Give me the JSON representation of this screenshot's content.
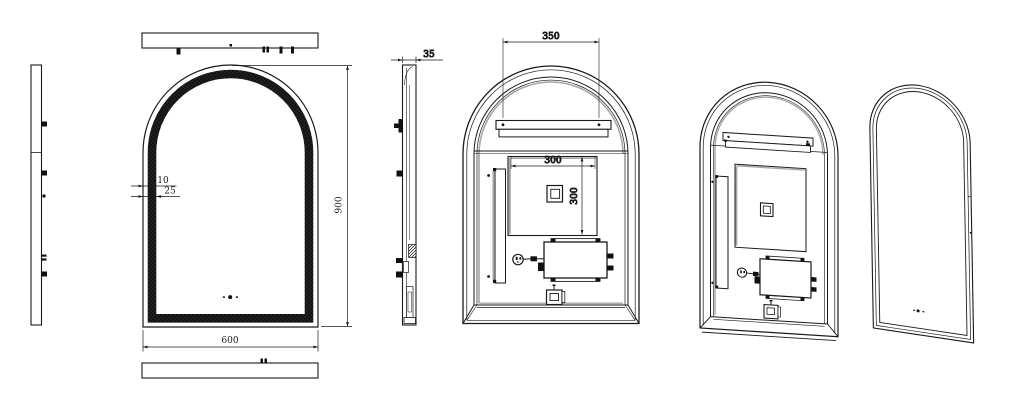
{
  "dimensions": {
    "front_frame_offset": "10",
    "front_led_band": "25",
    "front_width": "600",
    "front_height": "900",
    "side_depth": "35",
    "hanger_width": "350",
    "backplate_width": "300",
    "backplate_height": "300"
  },
  "icons": {
    "touch_sensor": "touch-sensor-dots",
    "power_plug": "power-plug"
  },
  "colors": {
    "line": "#1a1a1a",
    "led_band": "#141414",
    "shade_gray": "#a6a6a6",
    "background": "#ffffff"
  }
}
